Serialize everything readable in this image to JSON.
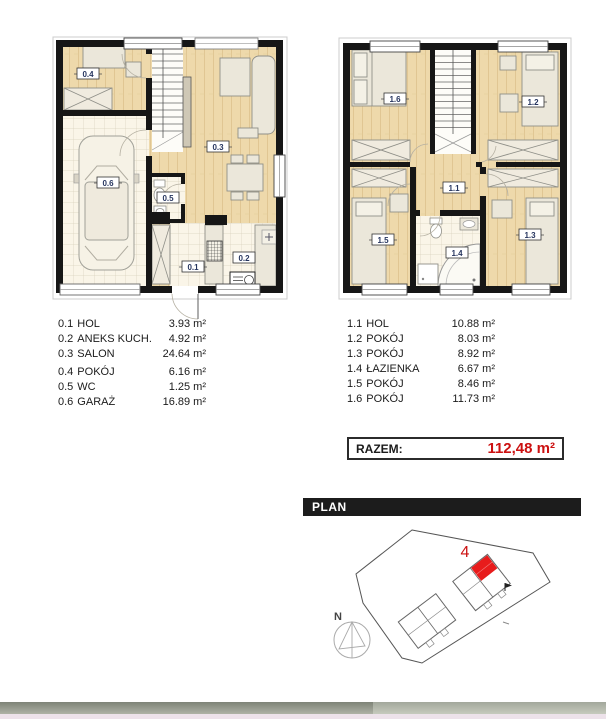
{
  "ground_floor": {
    "legend": [
      {
        "id": "0.1",
        "name": "HOL",
        "area": "3.93 m²"
      },
      {
        "id": "0.2",
        "name": "ANEKS KUCH.",
        "area": "4.92 m²"
      },
      {
        "id": "0.3",
        "name": "SALON",
        "area": "24.64 m²"
      },
      {
        "id": "0.4",
        "name": "POKÓJ",
        "area": "6.16 m²"
      },
      {
        "id": "0.5",
        "name": "WC",
        "area": "1.25 m²"
      },
      {
        "id": "0.6",
        "name": "GARAŻ",
        "area": "16.89 m²"
      }
    ]
  },
  "first_floor": {
    "legend": [
      {
        "id": "1.1",
        "name": "HOL",
        "area": "10.88 m²"
      },
      {
        "id": "1.2",
        "name": "POKÓJ",
        "area": "8.03 m²"
      },
      {
        "id": "1.3",
        "name": "POKÓJ",
        "area": "8.92 m²"
      },
      {
        "id": "1.4",
        "name": "ŁAZIENKA",
        "area": "6.67 m²"
      },
      {
        "id": "1.5",
        "name": "POKÓJ",
        "area": "8.46 m²"
      },
      {
        "id": "1.6",
        "name": "POKÓJ",
        "area": "11.73 m²"
      }
    ]
  },
  "total": {
    "label": "RAZEM:",
    "value": "112,48 m²"
  },
  "site_plan": {
    "header": "PLAN",
    "highlighted_unit": "4",
    "compass": "N"
  },
  "colors": {
    "accent_red": "#cc1111",
    "unit_red": "#e81c1c",
    "wall": "#161616",
    "wood": "#eed9ab",
    "tile": "#faf5e8",
    "header_bg": "#1c1c1c",
    "label_text": "#26355f"
  }
}
